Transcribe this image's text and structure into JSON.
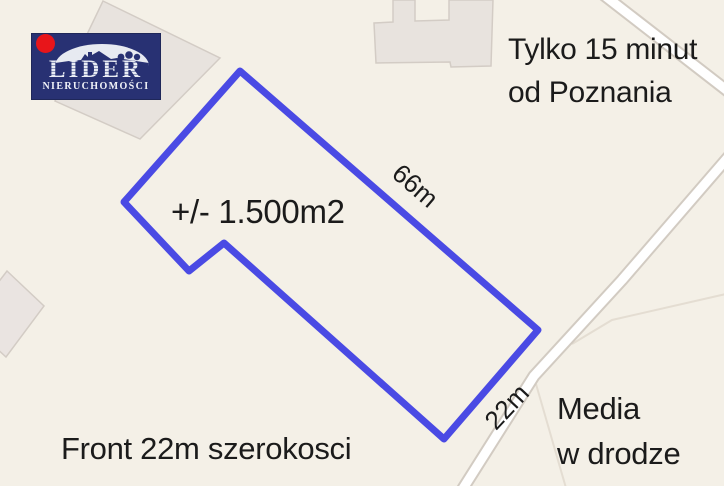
{
  "logo": {
    "brand": "LIDER",
    "subtitle": "NIERUCHOMOŚCI"
  },
  "annotations": {
    "top_right_line1": "Tylko 15 minut",
    "top_right_line2": "od Poznania",
    "area_label": "+/- 1.500m2",
    "long_side_label": "66m",
    "front_side_label": "22m",
    "bottom_left": "Front 22m szerokosci",
    "bottom_right_line1": "Media",
    "bottom_right_line2": "w drodze"
  },
  "map": {
    "background_color": "#f4f0e7",
    "plot_outline_color": "#4a4ae4",
    "plot_outline_points": "240,71 538,330 444,439 224,243 189,271 124,202"
  }
}
